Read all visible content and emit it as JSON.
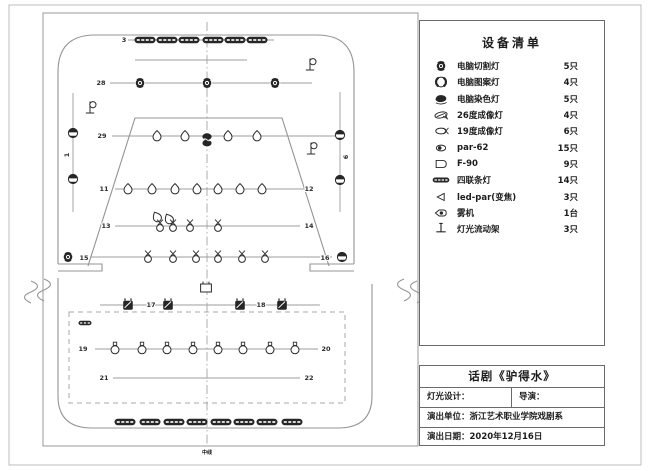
{
  "equipment_panel": {
    "title": "设备清单",
    "items": [
      {
        "icon": "cut",
        "icon_name": "moving-head-spot-icon",
        "name": "电脑切割灯",
        "qty": "5只"
      },
      {
        "icon": "pattern",
        "icon_name": "moving-head-gobo-icon",
        "name": "电脑图案灯",
        "qty": "4只"
      },
      {
        "icon": "wash",
        "icon_name": "moving-head-wash-icon",
        "name": "电脑染色灯",
        "qty": "5只"
      },
      {
        "icon": "profile26",
        "icon_name": "profile-26deg-icon",
        "name": "26度成像灯",
        "qty": "4只"
      },
      {
        "icon": "profile19",
        "icon_name": "profile-19deg-icon",
        "name": "19度成像灯",
        "qty": "6只"
      },
      {
        "icon": "par",
        "icon_name": "par-can-icon",
        "name": "par-62",
        "qty": "15只"
      },
      {
        "icon": "f90",
        "icon_name": "f90-lamp-icon",
        "name": "F-90",
        "qty": "9只"
      },
      {
        "icon": "strip",
        "icon_name": "quad-strip-light-icon",
        "name": "四联条灯",
        "qty": "14只"
      },
      {
        "icon": "ledpar",
        "icon_name": "led-par-zoom-icon",
        "name": "led-par(变焦)",
        "qty": "3只"
      },
      {
        "icon": "fog",
        "icon_name": "fog-machine-icon",
        "name": "雾机",
        "qty": "1台"
      },
      {
        "icon": "stand",
        "icon_name": "light-stand-icon",
        "name": "灯光流动架",
        "qty": "3只"
      }
    ]
  },
  "title_block": {
    "title": "话剧《驴得水》",
    "lighting_design_label": "灯光设计：",
    "director_label": "导演：",
    "company_label": "演出单位：",
    "company_value": "浙江艺术职业学院戏剧系",
    "date_label": "演出日期：",
    "date_value": "2020年12月16日"
  },
  "plot": {
    "center_label": "中线",
    "row_lines": [
      {
        "x1": 128,
        "y1": 40,
        "x2": 274,
        "y2": 40
      },
      {
        "x1": 135,
        "y1": 60,
        "x2": 247,
        "y2": 60
      },
      {
        "x1": 110,
        "y1": 83,
        "x2": 312,
        "y2": 83
      },
      {
        "x1": 112,
        "y1": 136,
        "x2": 335,
        "y2": 136
      },
      {
        "x1": 115,
        "y1": 189,
        "x2": 305,
        "y2": 189
      },
      {
        "x1": 115,
        "y1": 226,
        "x2": 300,
        "y2": 226
      },
      {
        "x1": 90,
        "y1": 257,
        "x2": 332,
        "y2": 257
      },
      {
        "x1": 100,
        "y1": 305,
        "x2": 320,
        "y2": 305
      },
      {
        "x1": 95,
        "y1": 349,
        "x2": 318,
        "y2": 349
      },
      {
        "x1": 113,
        "y1": 378,
        "x2": 300,
        "y2": 378
      },
      {
        "x1": 73,
        "y1": 93,
        "x2": 73,
        "y2": 212
      },
      {
        "x1": 340,
        "y1": 92,
        "x2": 340,
        "y2": 212
      }
    ],
    "labels": [
      {
        "t": "3",
        "x": 124,
        "y": 40
      },
      {
        "t": "28",
        "x": 101,
        "y": 83
      },
      {
        "t": "29",
        "x": 102,
        "y": 136
      },
      {
        "t": "11",
        "x": 104,
        "y": 189
      },
      {
        "t": "12",
        "x": 309,
        "y": 189
      },
      {
        "t": "13",
        "x": 106,
        "y": 226
      },
      {
        "t": "14",
        "x": 309,
        "y": 226
      },
      {
        "t": "15",
        "x": 84,
        "y": 258
      },
      {
        "t": "16",
        "x": 325,
        "y": 258
      },
      {
        "t": "17",
        "x": 151,
        "y": 305
      },
      {
        "t": "18",
        "x": 261,
        "y": 305
      },
      {
        "t": "19",
        "x": 83,
        "y": 349
      },
      {
        "t": "20",
        "x": 326,
        "y": 349
      },
      {
        "t": "21",
        "x": 104,
        "y": 378
      },
      {
        "t": "22",
        "x": 309,
        "y": 378
      },
      {
        "t": "1",
        "x": 67,
        "y": 155,
        "rot": -90
      },
      {
        "t": "6",
        "x": 346,
        "y": 157,
        "rot": -90
      }
    ],
    "fixtures": [
      {
        "type": "strip",
        "x": 145,
        "y": 40
      },
      {
        "type": "strip",
        "x": 167,
        "y": 40
      },
      {
        "type": "strip",
        "x": 189,
        "y": 40
      },
      {
        "type": "strip",
        "x": 213,
        "y": 40
      },
      {
        "type": "strip",
        "x": 235,
        "y": 40
      },
      {
        "type": "strip",
        "x": 257,
        "y": 40
      },
      {
        "type": "mover",
        "x": 140,
        "y": 83
      },
      {
        "type": "mover",
        "x": 207,
        "y": 83
      },
      {
        "type": "mover",
        "x": 275,
        "y": 83
      },
      {
        "type": "droplet",
        "x": 157,
        "y": 136
      },
      {
        "type": "droplet",
        "x": 185,
        "y": 136
      },
      {
        "type": "washpair",
        "x": 207,
        "y": 140
      },
      {
        "type": "droplet",
        "x": 228,
        "y": 136
      },
      {
        "type": "droplet",
        "x": 257,
        "y": 136
      },
      {
        "type": "droplet",
        "x": 128,
        "y": 189
      },
      {
        "type": "droplet",
        "x": 152,
        "y": 189
      },
      {
        "type": "droplet",
        "x": 175,
        "y": 189
      },
      {
        "type": "droplet",
        "x": 197,
        "y": 189
      },
      {
        "type": "droplet",
        "x": 218,
        "y": 189
      },
      {
        "type": "droplet",
        "x": 240,
        "y": 189
      },
      {
        "type": "droplet",
        "x": 262,
        "y": 189
      },
      {
        "type": "droplet",
        "x": 157,
        "y": 217,
        "rot": -28
      },
      {
        "type": "droplet",
        "x": 169,
        "y": 219,
        "rot": -28
      },
      {
        "type": "bell",
        "x": 160,
        "y": 226
      },
      {
        "type": "bell",
        "x": 173,
        "y": 226
      },
      {
        "type": "bell",
        "x": 190,
        "y": 226
      },
      {
        "type": "bell",
        "x": 218,
        "y": 226
      },
      {
        "type": "mover",
        "x": 68,
        "y": 257
      },
      {
        "type": "bell",
        "x": 148,
        "y": 257
      },
      {
        "type": "bell",
        "x": 173,
        "y": 257
      },
      {
        "type": "bell",
        "x": 196,
        "y": 257
      },
      {
        "type": "bell",
        "x": 218,
        "y": 257
      },
      {
        "type": "bell",
        "x": 242,
        "y": 257
      },
      {
        "type": "bell",
        "x": 265,
        "y": 257
      },
      {
        "type": "boomfix",
        "x": 342,
        "y": 257
      },
      {
        "type": "washsq",
        "x": 128,
        "y": 305
      },
      {
        "type": "washsq",
        "x": 168,
        "y": 305
      },
      {
        "type": "washsq",
        "x": 240,
        "y": 305
      },
      {
        "type": "washsq",
        "x": 282,
        "y": 305
      },
      {
        "type": "stripsmall",
        "x": 85,
        "y": 323
      },
      {
        "type": "parhead",
        "x": 115,
        "y": 349
      },
      {
        "type": "parhead",
        "x": 142,
        "y": 349
      },
      {
        "type": "parhead",
        "x": 167,
        "y": 349
      },
      {
        "type": "parhead",
        "x": 193,
        "y": 349
      },
      {
        "type": "parhead",
        "x": 218,
        "y": 349
      },
      {
        "type": "parhead",
        "x": 243,
        "y": 349
      },
      {
        "type": "parhead",
        "x": 270,
        "y": 349
      },
      {
        "type": "parhead",
        "x": 295,
        "y": 349
      },
      {
        "type": "strip",
        "x": 125,
        "y": 422
      },
      {
        "type": "strip",
        "x": 150,
        "y": 422
      },
      {
        "type": "strip",
        "x": 174,
        "y": 422
      },
      {
        "type": "strip",
        "x": 197,
        "y": 422
      },
      {
        "type": "strip",
        "x": 221,
        "y": 422
      },
      {
        "type": "strip",
        "x": 244,
        "y": 422
      },
      {
        "type": "strip",
        "x": 267,
        "y": 422
      },
      {
        "type": "strip",
        "x": 292,
        "y": 422
      },
      {
        "type": "boomfix",
        "x": 73,
        "y": 133
      },
      {
        "type": "boomfix",
        "x": 73,
        "y": 179
      },
      {
        "type": "boomfix",
        "x": 340,
        "y": 135
      },
      {
        "type": "boomfix",
        "x": 340,
        "y": 180
      },
      {
        "type": "flag",
        "x": 90,
        "y": 110
      },
      {
        "type": "flag",
        "x": 310,
        "y": 67
      },
      {
        "type": "flag",
        "x": 311,
        "y": 151
      },
      {
        "type": "hazer",
        "x": 206,
        "y": 288
      }
    ]
  }
}
